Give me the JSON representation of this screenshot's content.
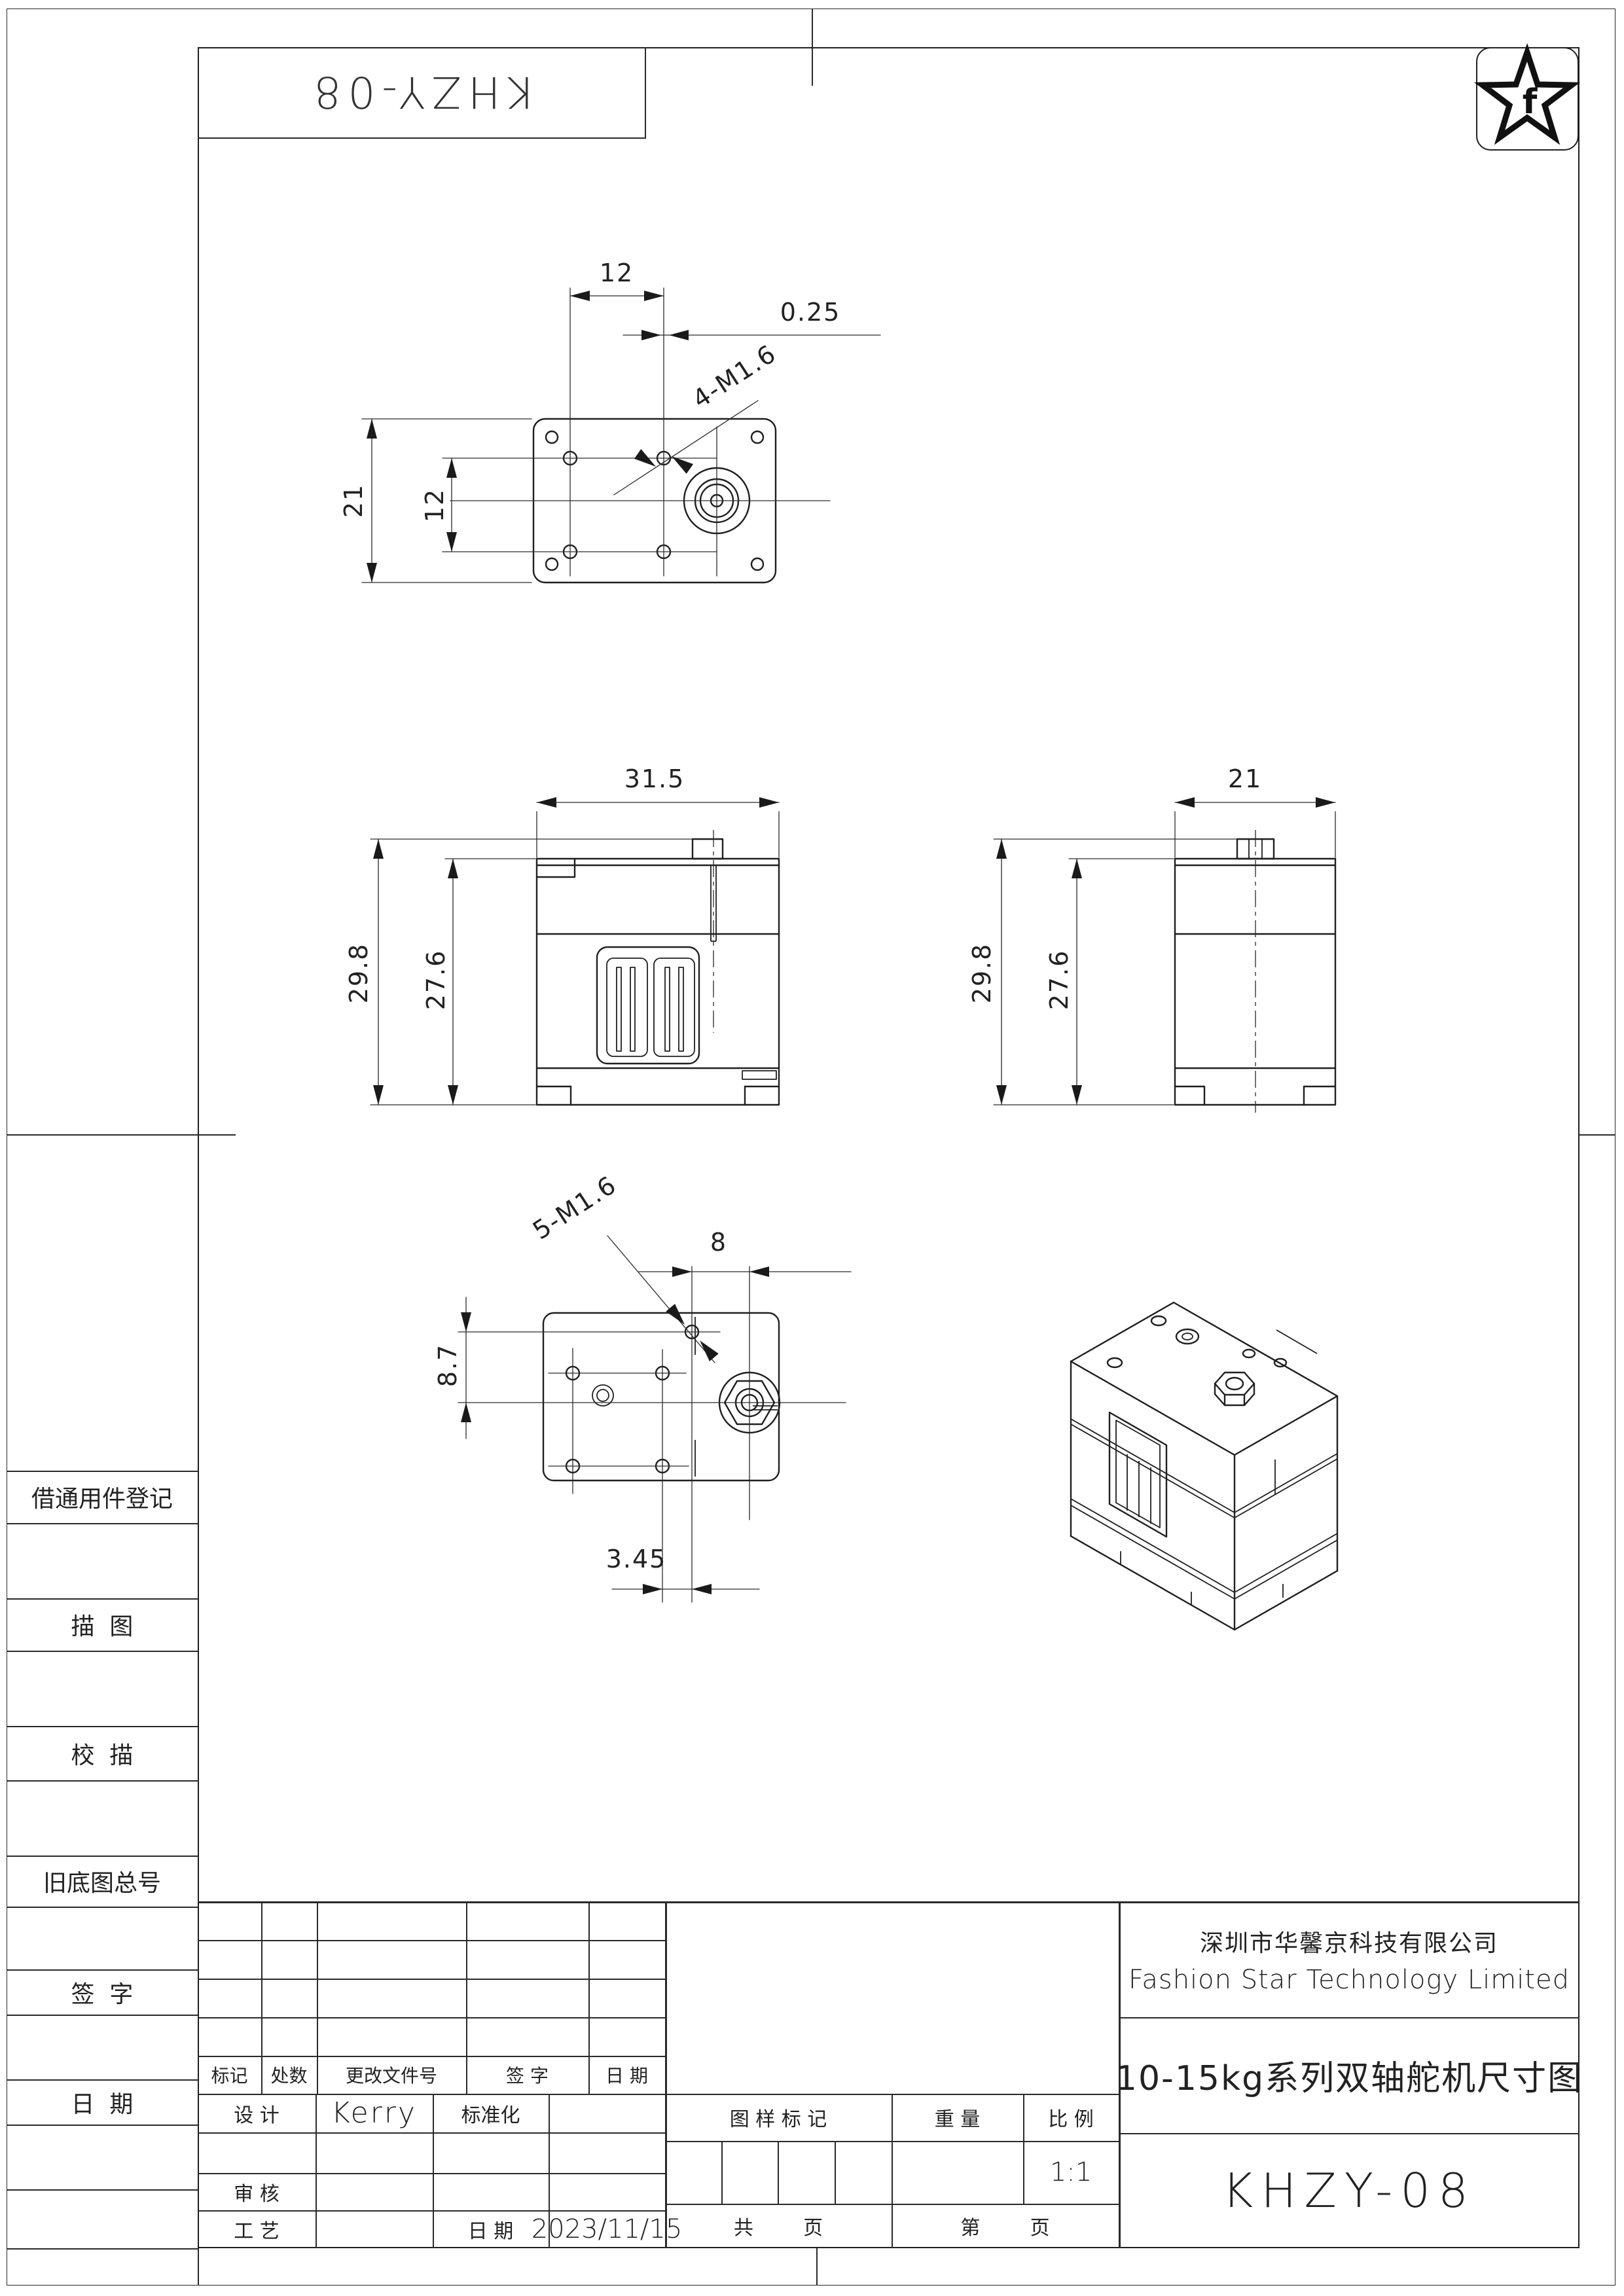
{
  "stamp": {
    "code": "KHZY-08"
  },
  "logo": {
    "letter": "f"
  },
  "sidebar": {
    "items": [
      "借通用件登记",
      "描  图",
      "校  描",
      "旧底图总号",
      "签  字",
      "日  期"
    ]
  },
  "views": {
    "top": {
      "dim_spacing_x": "12",
      "dim_offset": "0.25",
      "thread_label": "4-M1.6",
      "dim_height": "21",
      "dim_spacing_y": "12"
    },
    "front": {
      "dim_width": "31.5",
      "dim_total_h": "29.8",
      "dim_body_h": "27.6"
    },
    "side": {
      "dim_width": "21",
      "dim_total_h": "29.8",
      "dim_body_h": "27.6"
    },
    "bottom": {
      "thread_label": "5-M1.6",
      "dim_shaft": "8",
      "dim_row": "8.7",
      "dim_col": "3.45"
    }
  },
  "titleblock": {
    "company_cn": "深圳市华馨京科技有限公司",
    "company_en": "Fashion Star Technology Limited",
    "drawing_title": "10-15kg系列双轴舵机尺寸图",
    "drawing_no": "KHZY-08",
    "rev_headers": [
      "标记",
      "处数",
      "更改文件号",
      "签 字",
      "日 期"
    ],
    "design_label": "设 计",
    "designer": "Kerry",
    "standard_label": "标准化",
    "audit_label": "审 核",
    "process_label": "工 艺",
    "date_label": "日 期",
    "date_value": "2023/11/15",
    "stamp_label": "图 样 标 记",
    "weight_label": "重 量",
    "scale_label": "比 例",
    "scale_value": "1:1",
    "pages_total_label": "共        页",
    "page_no_label": "第        页"
  }
}
